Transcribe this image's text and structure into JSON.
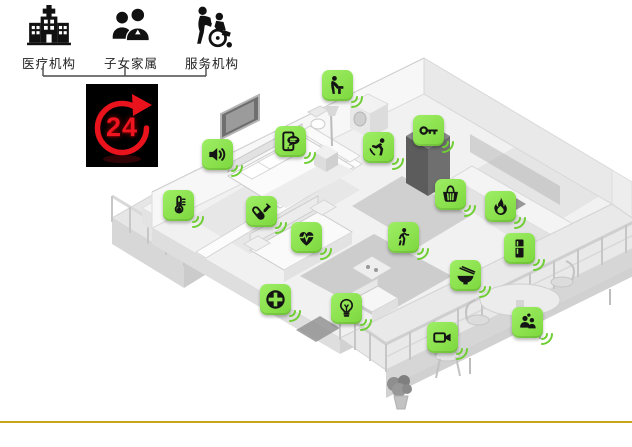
{
  "stakeholders": {
    "items": [
      {
        "id": "medical-institution",
        "label": "医疗机构",
        "icon": "hospital-icon"
      },
      {
        "id": "family-members",
        "label": "子女家属",
        "icon": "family-icon"
      },
      {
        "id": "service-agency",
        "label": "服务机构",
        "icon": "caregiver-icon"
      }
    ]
  },
  "service_badge": {
    "text": "24",
    "icon": "24-hour-cycle-icon"
  },
  "colors": {
    "sensor_green": "#8ce24f",
    "wave_green": "#6fce33",
    "badge_red": "#e8131c",
    "badge_bg": "#000000",
    "gold_line": "#c9a51b",
    "glyph_black": "#141414"
  },
  "sensors": [
    {
      "id": "audio-alarm",
      "icon": "speaker-icon",
      "x": 217,
      "y": 154
    },
    {
      "id": "voice-intercom",
      "icon": "message-phone-icon",
      "x": 290,
      "y": 141
    },
    {
      "id": "washbasin-monitor",
      "icon": "washing-person-icon",
      "x": 337,
      "y": 85
    },
    {
      "id": "fall-detector",
      "icon": "falling-person-icon",
      "x": 378,
      "y": 147
    },
    {
      "id": "smart-lock",
      "icon": "key-icon",
      "x": 428,
      "y": 130
    },
    {
      "id": "temperature-sensor",
      "icon": "thermometer-icon",
      "x": 178,
      "y": 205
    },
    {
      "id": "medication-reminder",
      "icon": "pills-icon",
      "x": 261,
      "y": 211
    },
    {
      "id": "heart-rate-monitor",
      "icon": "heart-ecg-icon",
      "x": 306,
      "y": 237
    },
    {
      "id": "motion-sensor",
      "icon": "walking-person-icon",
      "x": 403,
      "y": 237
    },
    {
      "id": "grocery-service",
      "icon": "shopping-basket-icon",
      "x": 450,
      "y": 194
    },
    {
      "id": "gas-fire-alarm",
      "icon": "flame-icon",
      "x": 500,
      "y": 206
    },
    {
      "id": "smart-fridge",
      "icon": "fridge-icon",
      "x": 519,
      "y": 248
    },
    {
      "id": "meal-service",
      "icon": "rice-bowl-icon",
      "x": 465,
      "y": 275
    },
    {
      "id": "emergency-call",
      "icon": "medical-cross-icon",
      "x": 275,
      "y": 299
    },
    {
      "id": "smart-light",
      "icon": "bulb-icon",
      "x": 346,
      "y": 308
    },
    {
      "id": "video-monitor",
      "icon": "video-camera-icon",
      "x": 442,
      "y": 337
    },
    {
      "id": "visitor-monitor",
      "icon": "people-icon",
      "x": 527,
      "y": 322
    }
  ]
}
